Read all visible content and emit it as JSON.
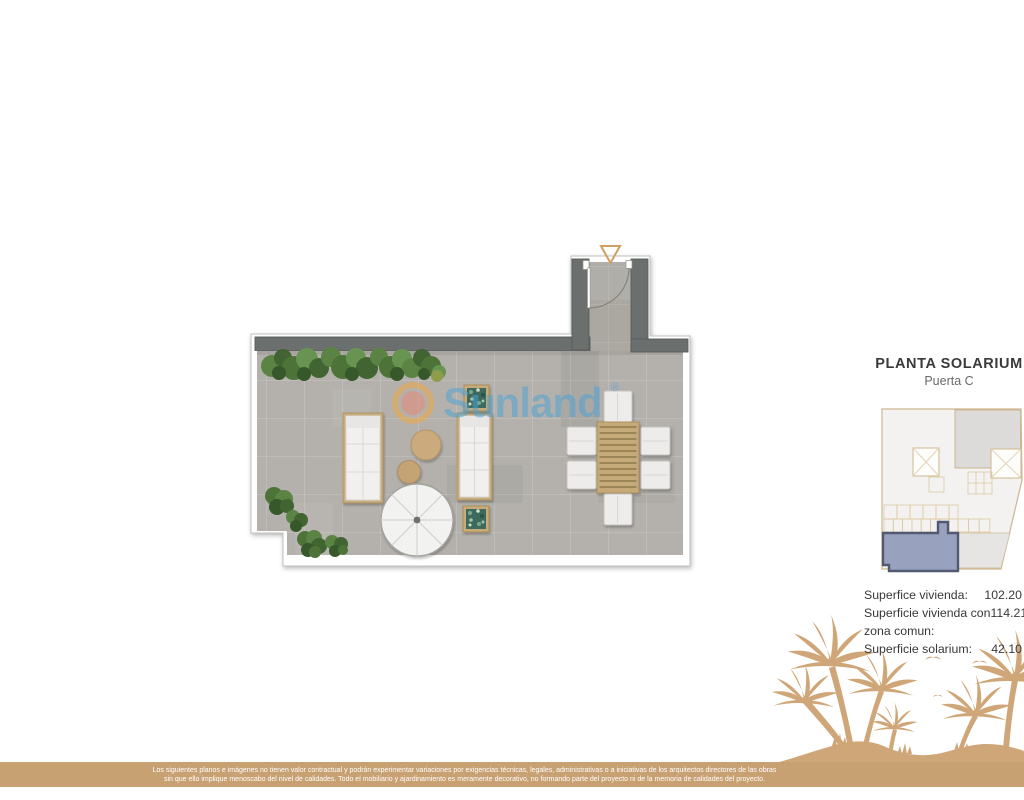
{
  "header": {
    "title": "PLANTA SOLARIUM",
    "subtitle": "Puerta C"
  },
  "watermark": {
    "brand": "Sunland",
    "registered": "®"
  },
  "areas": {
    "rows": [
      {
        "label": "Superfice vivienda:",
        "value": "102.20"
      },
      {
        "label": "Superficie vivienda con",
        "value": "114.21"
      },
      {
        "label": "zona comun:",
        "value": ""
      },
      {
        "label": "Superficie solarium:",
        "value": "42.10"
      }
    ]
  },
  "disclaimer": {
    "line1": "Los siguientes planos e imágenes no tienen valor contractual y podrán experimentar variaciones por exigencias técnicas, legales, administrativas o a iniciativas de los arquitectos directores de las obras",
    "line2": "sin que ello implique menoscabo del nivel de calidades. Todo el mobiliario y ajardinamiento es meramente decorativo, no formando parte del proyecto ni de la memoria de calidades del proyecto."
  },
  "colors": {
    "wall_gray": "#6b706f",
    "floor_tile": "#b4b1ac",
    "accent_tan": "#c8a173",
    "palm_tan": "#cfa678",
    "unit_highlight_fill": "#98a2bf",
    "unit_highlight_stroke": "#515a70",
    "entry_arrow": "#cf9f63",
    "watermark_blue": "#4aa2d4",
    "watermark_orange": "#f2a73c",
    "watermark_salmon": "#e58979"
  }
}
